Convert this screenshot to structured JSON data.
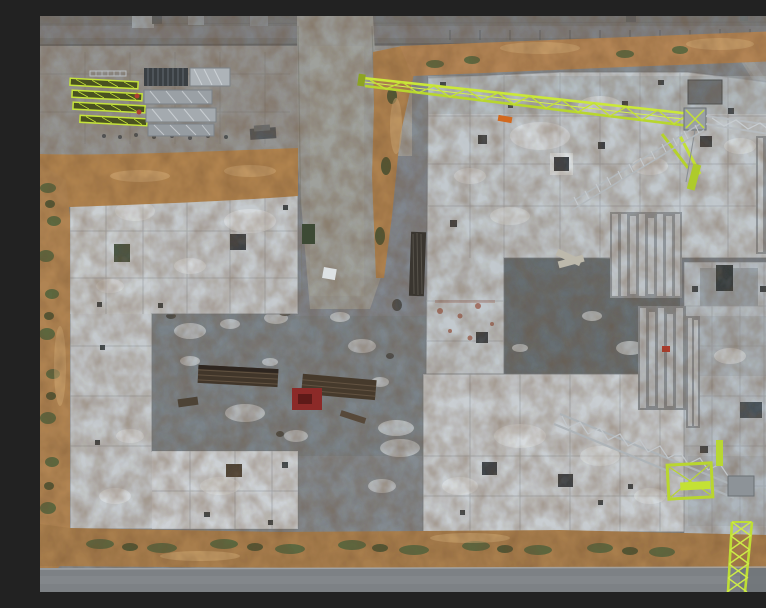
{
  "overlay": {
    "timestamp": "21.0"
  },
  "scene": {
    "description": "Aerial top-down drone photograph of a residential construction site at dusk: U-shaped concrete foundation slabs around gravel courtyards, a lime-green tower crane jib with grey counter-jib, crane mast sections being assembled, stacked precast panels, timber piles, a paved staging yard with lime truss segments, surrounded by excavated earth berms, sparse vegetation and access roads.",
    "entities": [
      "top-access-road",
      "staging-yard",
      "lime-truss-stack",
      "formwork-stack",
      "vertical-access-road",
      "earth-berm",
      "upper-left-foundation-slab",
      "upper-right-foundation-slab",
      "bottom-foundation-slab",
      "right-wing-structures",
      "tower-crane-jib",
      "tower-crane-counter-jib",
      "counterweight-block",
      "crane-ladder-truss",
      "crane-mast-section",
      "timber-pile",
      "red-material-pile",
      "precast-panel-stack",
      "bottom-access-road",
      "timestamp-overlay"
    ]
  },
  "palette": {
    "gravel": "#858c92",
    "gravel_dark": "#696f73",
    "concrete_slab": "#c6cbcf",
    "concrete_bright": "#e2e6e8",
    "dirt": "#b08350",
    "dirt_dark": "#6b4a2c",
    "vegetation": "#55653f",
    "road": "#7b7d7e",
    "crane_lime": "#c4e134",
    "crane_grey": "#b3b9bd",
    "timber": "#41362a",
    "red_pile": "#8c2a28",
    "timestamp_color": "#ffffff"
  }
}
